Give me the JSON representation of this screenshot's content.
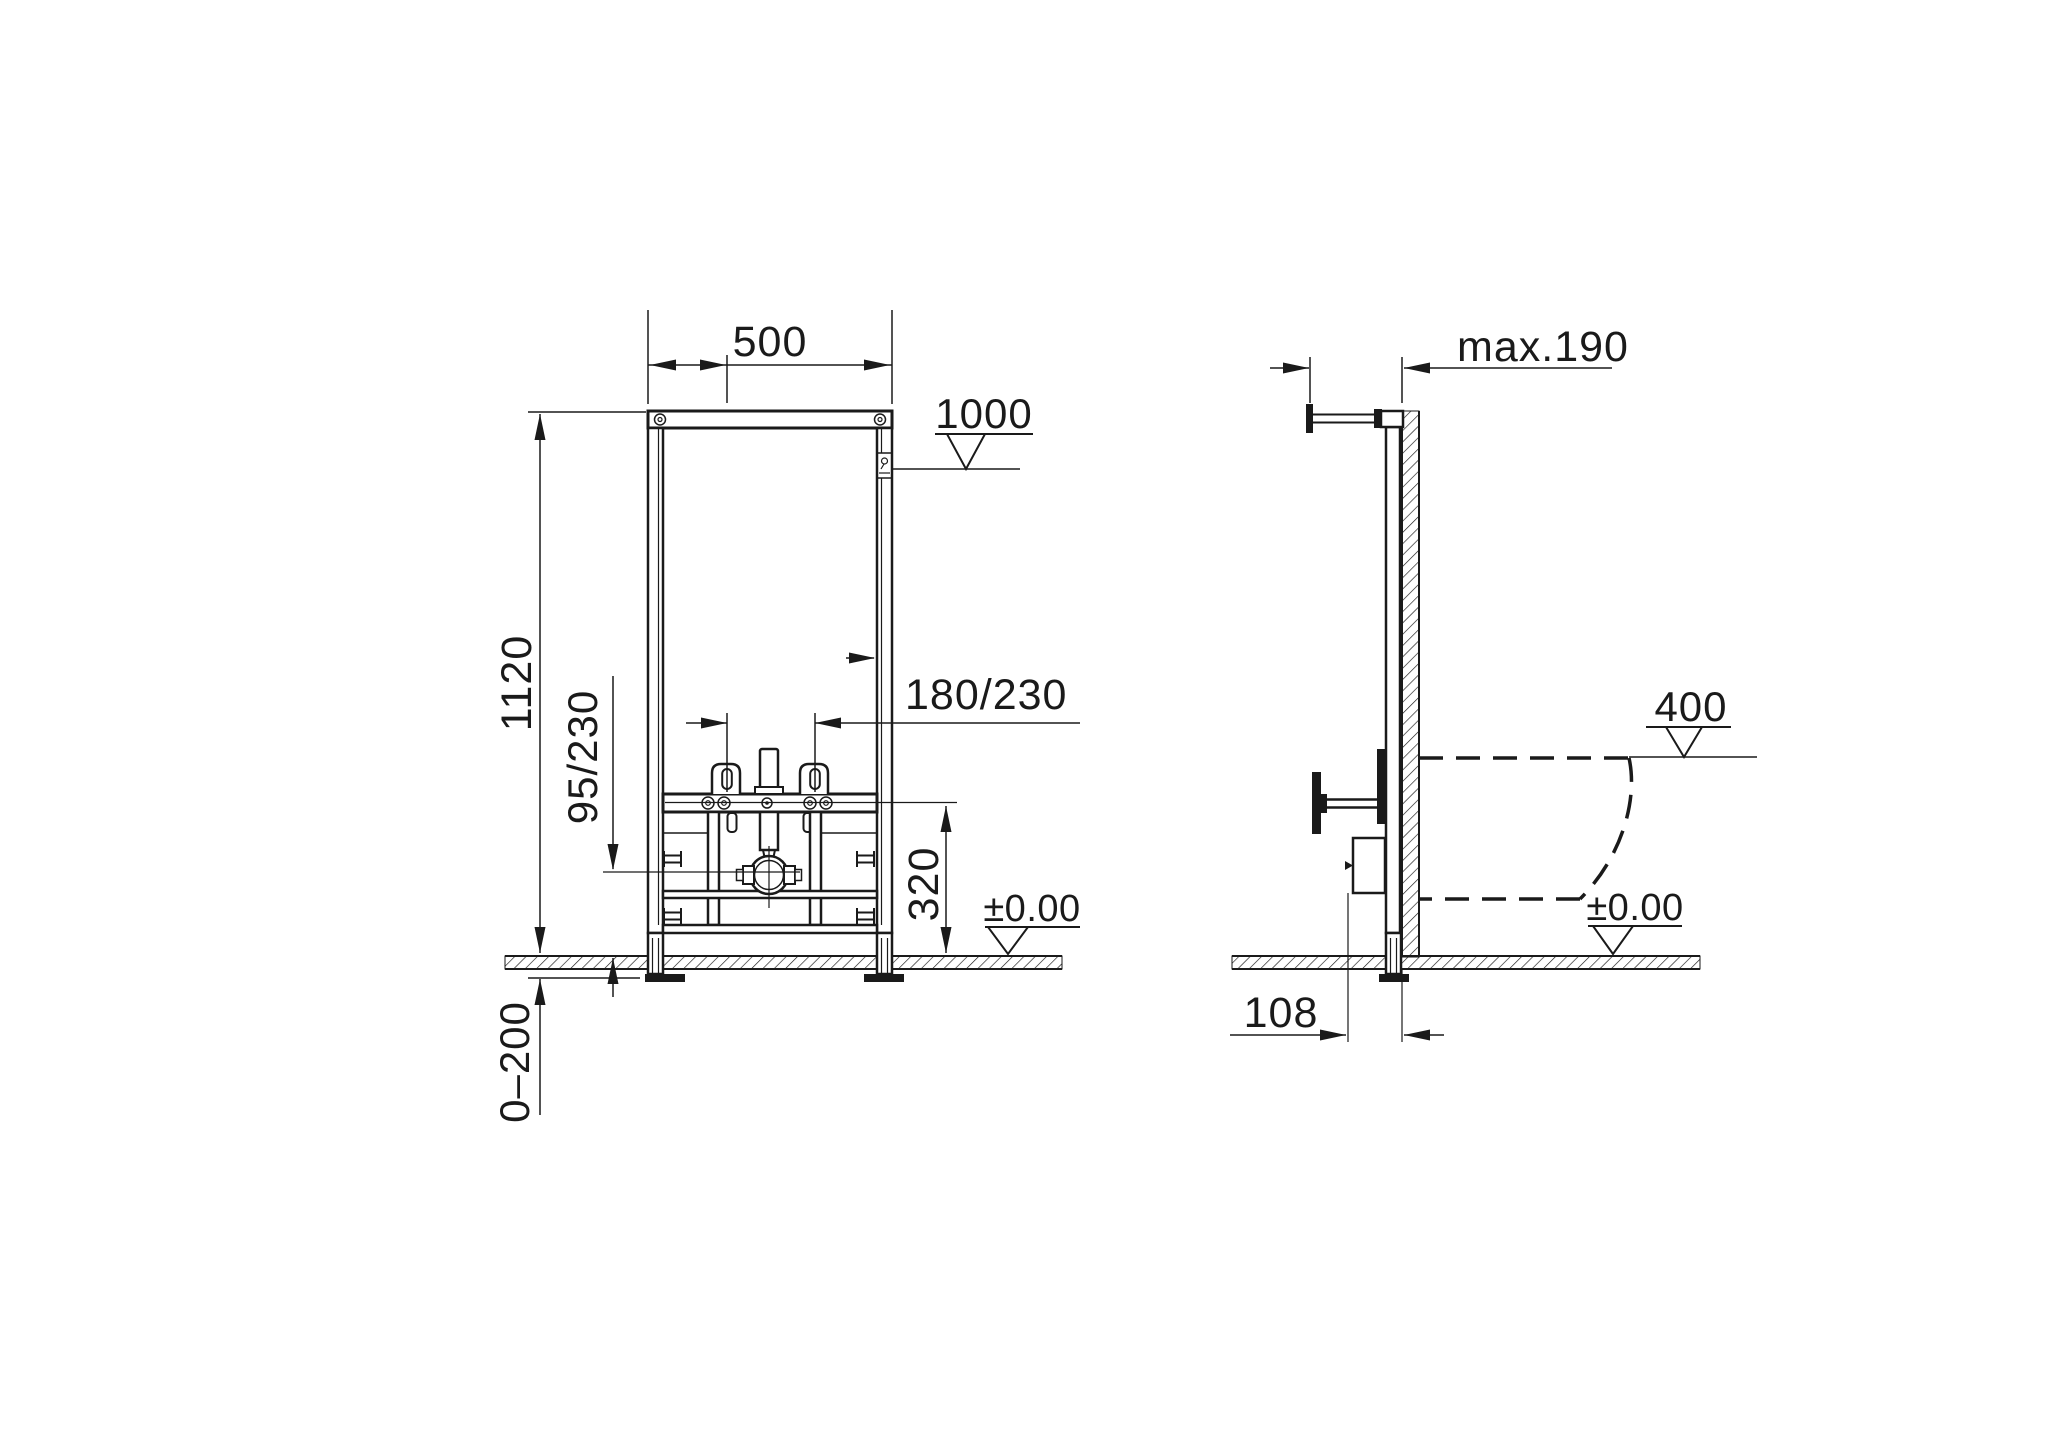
{
  "drawing": {
    "front_view": {
      "width": "500",
      "height": "1120",
      "top_fixing_level": "1000",
      "stud_spacing": "180/230",
      "water_inlet_height": "95/230",
      "drain_height": "320",
      "floor_level": "±0.00",
      "foot_adjustment": "0–200"
    },
    "side_view": {
      "max_depth": "max.190",
      "rim_level": "400",
      "floor_level": "±0.00",
      "drain_wall_offset": "108"
    },
    "colors": {
      "line": "#1a1a1a",
      "background": "#ffffff"
    }
  }
}
